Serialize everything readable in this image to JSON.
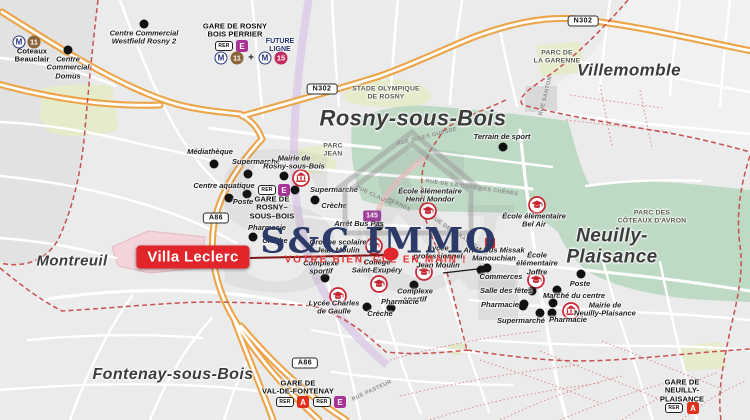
{
  "brand": {
    "name": "S&C IMMO",
    "tagline": "VOTRE BIEN, CLÉ EN MAIN !"
  },
  "property": {
    "label": "Villa Leclerc"
  },
  "cities": [
    {
      "label": "Rosny-sous-Bois",
      "x": 413,
      "y": 119,
      "size": 22
    },
    {
      "label": "Villemomble",
      "x": 629,
      "y": 70,
      "size": 17
    },
    {
      "label": "Neuilly-Plaisance",
      "x": 612,
      "y": 247,
      "size": 19
    },
    {
      "label": "Montreuil",
      "x": 72,
      "y": 262,
      "size": 15
    },
    {
      "label": "Fontenay-sous-Bois",
      "x": 173,
      "y": 375,
      "size": 16
    }
  ],
  "parks": [
    {
      "label": "STADE OLYMPIQUE\nDE ROSNY",
      "x": 386,
      "y": 93
    },
    {
      "label": "PARC DE\nLA GARENNE",
      "x": 557,
      "y": 57
    },
    {
      "label": "PARC DES\nCÔTEAUX D'AVRON",
      "x": 652,
      "y": 217
    },
    {
      "label": "PARC\nJEAN",
      "x": 333,
      "y": 150
    }
  ],
  "stations": [
    {
      "label": "GARE DE ROSNY\nBOIS PERRIER",
      "x": 235,
      "y": 31
    },
    {
      "label": "Coteaux\nBeauclair",
      "x": 32,
      "y": 56
    },
    {
      "label": "GARE DE\nROSNY–\nSOUS–BOIS",
      "x": 272,
      "y": 208
    },
    {
      "label": "GARE DE\nVAL-DE-FONTENAY",
      "x": 298,
      "y": 388
    },
    {
      "label": "GARE DE\nNEUILLY-PLAISANCE",
      "x": 682,
      "y": 391
    }
  ],
  "future_line": {
    "label": "FUTURE\nLIGNE",
    "x": 280,
    "y": 46
  },
  "pois": [
    {
      "label": "Centre Commercial\nWestfield Rosny 2",
      "x": 144,
      "y": 38,
      "dots": [
        [
          144,
          24
        ]
      ]
    },
    {
      "label": "Centre\nCommercial\nDomus",
      "x": 68,
      "y": 68,
      "dots": [
        [
          68,
          50
        ]
      ]
    },
    {
      "label": "Médiathèque",
      "x": 210,
      "y": 152,
      "dots": [
        [
          214,
          164
        ]
      ]
    },
    {
      "label": "Supermarché",
      "x": 256,
      "y": 162,
      "dots": [
        [
          248,
          174
        ]
      ]
    },
    {
      "label": "Mairie de\nRosny-sous-Bois",
      "x": 294,
      "y": 163,
      "dots": [
        [
          284,
          176
        ]
      ],
      "icon": {
        "type": "mairie",
        "x": 301,
        "y": 178
      }
    },
    {
      "label": "Centre aquatique",
      "x": 224,
      "y": 186,
      "dots": [
        [
          247,
          194
        ]
      ]
    },
    {
      "label": "Poste",
      "x": 243,
      "y": 202,
      "dots": [
        [
          229,
          198
        ]
      ]
    },
    {
      "label": "Supermarché",
      "x": 334,
      "y": 190,
      "dots": [
        [
          295,
          190
        ]
      ]
    },
    {
      "label": "Crèche",
      "x": 334,
      "y": 206,
      "dots": [
        [
          315,
          200
        ]
      ]
    },
    {
      "label": "Pharmacie",
      "x": 267,
      "y": 228,
      "dots": [
        [
          253,
          237
        ]
      ]
    },
    {
      "label": "Crèche",
      "x": 275,
      "y": 241,
      "dots": []
    },
    {
      "label": "Arrêt Bus Pas",
      "x": 359,
      "y": 224,
      "dots": [
        [
          379,
          226
        ]
      ]
    },
    {
      "label": "Groupe scolaire\nJean Moulin",
      "x": 338,
      "y": 247,
      "icon": {
        "type": "school",
        "x": 374,
        "y": 246
      }
    },
    {
      "label": "Lycée\nprofessionnel\nJean Moulin",
      "x": 438,
      "y": 257,
      "icon": {
        "type": "school",
        "x": 424,
        "y": 272
      }
    },
    {
      "label": "Collège\nSaint-Exupéry",
      "x": 377,
      "y": 267,
      "icon": {
        "type": "school",
        "x": 379,
        "y": 284
      }
    },
    {
      "label": "Complexe\nsportif",
      "x": 321,
      "y": 268,
      "dots": [
        [
          325,
          278
        ]
      ]
    },
    {
      "label": "Complexe\nsportif",
      "x": 415,
      "y": 296,
      "dots": [
        [
          414,
          285
        ]
      ]
    },
    {
      "label": "Pharmacie",
      "x": 400,
      "y": 302,
      "dots": [
        [
          391,
          308
        ]
      ]
    },
    {
      "label": "Crèche",
      "x": 380,
      "y": 314,
      "dots": [
        [
          367,
          307
        ]
      ]
    },
    {
      "label": "Lycée Charles\nde Gaulle",
      "x": 334,
      "y": 308,
      "icon": {
        "type": "school",
        "x": 338,
        "y": 296
      }
    },
    {
      "label": "Arrêt Bus Missak\nManouchian",
      "x": 494,
      "y": 255,
      "dots": [
        [
          487,
          268
        ]
      ]
    },
    {
      "label": "École élémentaire\nHenri Mondor",
      "x": 430,
      "y": 196,
      "icon": {
        "type": "school",
        "x": 428,
        "y": 211
      }
    },
    {
      "label": "École élémentaire\nBel Air",
      "x": 534,
      "y": 221,
      "icon": {
        "type": "school",
        "x": 537,
        "y": 205
      }
    },
    {
      "label": "École\nélémentaire\nJoffre",
      "x": 537,
      "y": 264,
      "icon": {
        "type": "school",
        "x": 536,
        "y": 280
      }
    },
    {
      "label": "Poste",
      "x": 580,
      "y": 284,
      "dots": [
        [
          581,
          274
        ]
      ]
    },
    {
      "label": "Commerces",
      "x": 501,
      "y": 277,
      "dots": [
        [
          481,
          270
        ]
      ]
    },
    {
      "label": "Salle des fêtes",
      "x": 506,
      "y": 291,
      "dots": [
        [
          532,
          291
        ]
      ]
    },
    {
      "label": "Marché du centre",
      "x": 574,
      "y": 296,
      "dots": [
        [
          557,
          290
        ]
      ]
    },
    {
      "label": "Pharmacie",
      "x": 500,
      "y": 305,
      "dots": [
        [
          523,
          306
        ]
      ]
    },
    {
      "label": "Mairie de\nNeuilly-Plaisance",
      "x": 605,
      "y": 310,
      "icon": {
        "type": "mairie",
        "x": 571,
        "y": 311
      }
    },
    {
      "label": "Supermarché",
      "x": 521,
      "y": 321,
      "dots": [
        [
          540,
          313
        ],
        [
          552,
          313
        ]
      ]
    },
    {
      "label": "Pharmacie",
      "x": 568,
      "y": 320,
      "dots": [
        [
          524,
          304
        ],
        [
          553,
          303
        ]
      ]
    },
    {
      "label": "Terrain de sport",
      "x": 502,
      "y": 137,
      "dots": [
        [
          503,
          147
        ]
      ]
    }
  ],
  "badges": [
    {
      "t": "m",
      "text": "M",
      "x": 19,
      "y": 42
    },
    {
      "t": "circ",
      "text": "11",
      "bg": "#8a6538",
      "x": 34,
      "y": 42
    },
    {
      "t": "rer",
      "text": "RER",
      "x": 224,
      "y": 46
    },
    {
      "t": "sq",
      "text": "E",
      "bg": "#a93297",
      "x": 242,
      "y": 46
    },
    {
      "t": "m",
      "text": "M",
      "x": 221,
      "y": 58
    },
    {
      "t": "circ",
      "text": "11",
      "bg": "#8a6538",
      "x": 237,
      "y": 58
    },
    {
      "t": "plus",
      "text": "+",
      "x": 251,
      "y": 58
    },
    {
      "t": "m",
      "text": "M",
      "x": 265,
      "y": 58
    },
    {
      "t": "circ",
      "text": "15",
      "bg": "#c22a60",
      "x": 281,
      "y": 58
    },
    {
      "t": "rer",
      "text": "RER",
      "x": 267,
      "y": 190
    },
    {
      "t": "sq",
      "text": "E",
      "bg": "#a93297",
      "x": 284,
      "y": 190
    },
    {
      "t": "bus",
      "text": "145",
      "bg": "#a13f9e",
      "x": 372,
      "y": 216
    },
    {
      "t": "bus",
      "text": "1",
      "bg": "#d6212b",
      "x": 490,
      "y": 243
    },
    {
      "t": "rer",
      "text": "RER",
      "x": 285,
      "y": 402
    },
    {
      "t": "sq",
      "text": "A",
      "bg": "#e0301e",
      "x": 303,
      "y": 402
    },
    {
      "t": "rer",
      "text": "RER",
      "x": 322,
      "y": 402
    },
    {
      "t": "sq",
      "text": "E",
      "bg": "#a93297",
      "x": 340,
      "y": 402
    },
    {
      "t": "rer",
      "text": "RER",
      "x": 674,
      "y": 408
    },
    {
      "t": "sq",
      "text": "A",
      "bg": "#e0301e",
      "x": 693,
      "y": 408
    },
    {
      "t": "road",
      "text": "N302",
      "x": 322,
      "y": 89
    },
    {
      "t": "road",
      "text": "N302",
      "x": 583,
      "y": 21
    },
    {
      "t": "road",
      "text": "A86",
      "x": 216,
      "y": 218
    },
    {
      "t": "road",
      "text": "A86",
      "x": 305,
      "y": 363
    }
  ],
  "street_names": [
    {
      "text": "RUE JULES GUESDE",
      "x": 427,
      "y": 137,
      "rot": -14
    },
    {
      "text": "RUE CLAUDE",
      "x": 374,
      "y": 196,
      "rot": 26
    },
    {
      "text": "PERNÈS",
      "x": 399,
      "y": 205,
      "rot": 26
    },
    {
      "text": "RUE DE LA CÔTE DES CHÊNES",
      "x": 472,
      "y": 188,
      "rot": 8
    },
    {
      "text": "RUE DE STRASBOURG",
      "x": 459,
      "y": 236,
      "rot": 34
    },
    {
      "text": "RUE PASTEUR",
      "x": 372,
      "y": 391,
      "rot": -25
    },
    {
      "text": "RUE SANTON",
      "x": 546,
      "y": 96,
      "rot": -76
    }
  ]
}
